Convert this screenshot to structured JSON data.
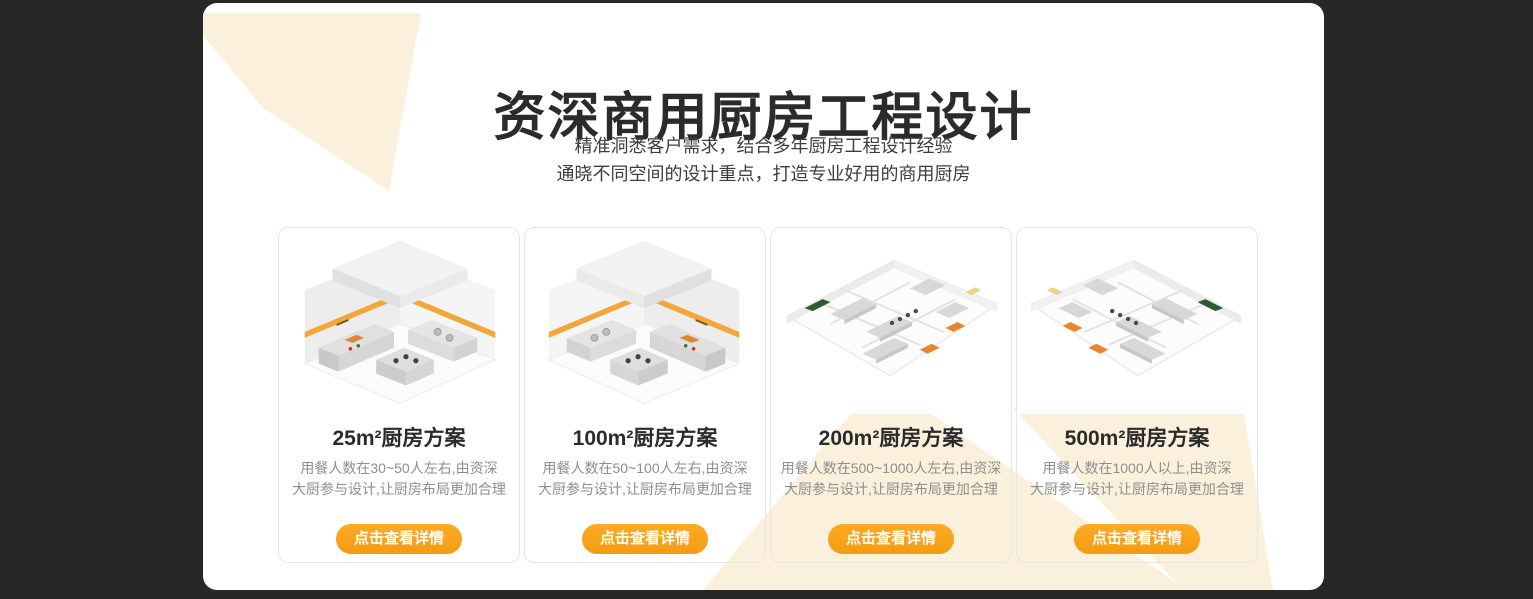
{
  "theme": {
    "page_background": "#272727",
    "panel_background": "#ffffff",
    "accent_orange": "#f7a11d",
    "watermark_cream": "#fbf0dc",
    "title_color": "#2b2b2b",
    "description_color": "#8e8e8e"
  },
  "header": {
    "title": "资深商用厨房工程设计",
    "subtitle_line1": "精准洞悉客户需求，结合多年厨房工程设计经验",
    "subtitle_line2": "通晓不同空间的设计重点，打造专业好用的商用厨房"
  },
  "cards": [
    {
      "title": "25m²厨房方案",
      "desc_line1": "用餐人数在30~50人左右,由资深",
      "desc_line2": "大厨参与设计,让厨房布局更加合理",
      "button_label": "点击查看详情"
    },
    {
      "title": "100m²厨房方案",
      "desc_line1": "用餐人数在50~100人左右,由资深",
      "desc_line2": "大厨参与设计,让厨房布局更加合理",
      "button_label": "点击查看详情"
    },
    {
      "title": "200m²厨房方案",
      "desc_line1": "用餐人数在500~1000人左右,由资深",
      "desc_line2": "大厨参与设计,让厨房布局更加合理",
      "button_label": "点击查看详情"
    },
    {
      "title": "500m²厨房方案",
      "desc_line1": "用餐人数在1000人以上,由资深",
      "desc_line2": "大厨参与设计,让厨房布局更加合理",
      "button_label": "点击查看详情"
    }
  ]
}
